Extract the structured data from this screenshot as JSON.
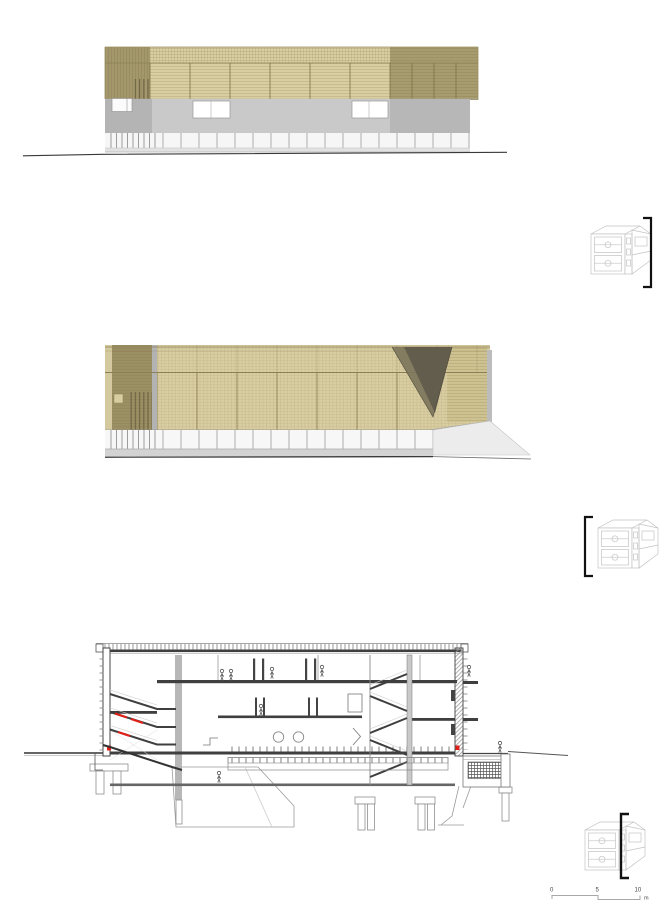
{
  "sheet": {
    "panels": [
      {
        "id": "elevation-a",
        "kind": "long elevation with timber screen"
      },
      {
        "id": "elevation-b",
        "kind": "long elevation with full-height screen and ramp void"
      },
      {
        "id": "cross-section",
        "kind": "building cross section with stairs and foundations"
      }
    ],
    "key_diagrams": [
      {
        "id": "key-elevation-a",
        "marker_side": "right"
      },
      {
        "id": "key-elevation-b",
        "marker_side": "left"
      },
      {
        "id": "key-section",
        "marker_side": "center"
      }
    ]
  },
  "scale_bar": {
    "ticks": [
      "0",
      "5",
      "10"
    ],
    "unit": "m"
  },
  "colors": {
    "paper": "#ffffff",
    "screen_tan": "#d9cea2",
    "screen_tan_dark": "#a3976b",
    "screen_tan_deep": "#9b8f64",
    "triangle_mid": "#7b745a",
    "triangle_dark": "#5e594a",
    "gray_band": "#c9c9c9",
    "gray_dark": "#b4b4b4",
    "base_light": "#f6f6f6",
    "plinth_gray": "#d3d3d3",
    "line_dark": "#3a3a3a",
    "line_mid": "#8d8159",
    "accent_red": "#e02018",
    "thumb_line": "#c2c2c2",
    "bracket_black": "#111111",
    "scale_line": "#a8a8a8"
  }
}
